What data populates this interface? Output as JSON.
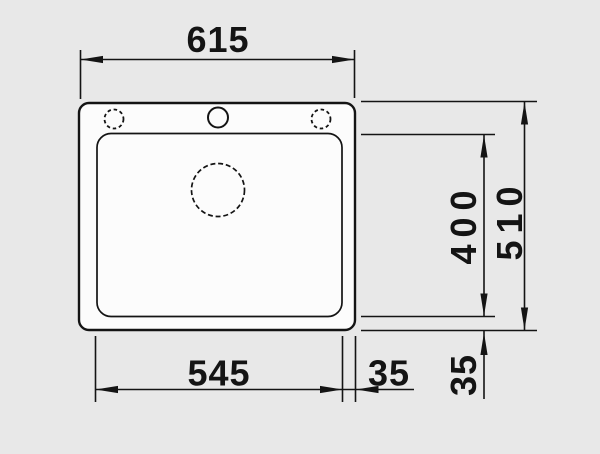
{
  "diagram": {
    "type": "sink-technical-drawing-top-view",
    "labels": {
      "overall_width": "615",
      "overall_depth": "510",
      "bowl_width": "545",
      "bowl_depth": "400",
      "offset_width": "35",
      "offset_depth": "35"
    },
    "colors": {
      "background": "#e8e8e8",
      "sink_fill": "#fcfcfc",
      "line": "#141414"
    }
  }
}
